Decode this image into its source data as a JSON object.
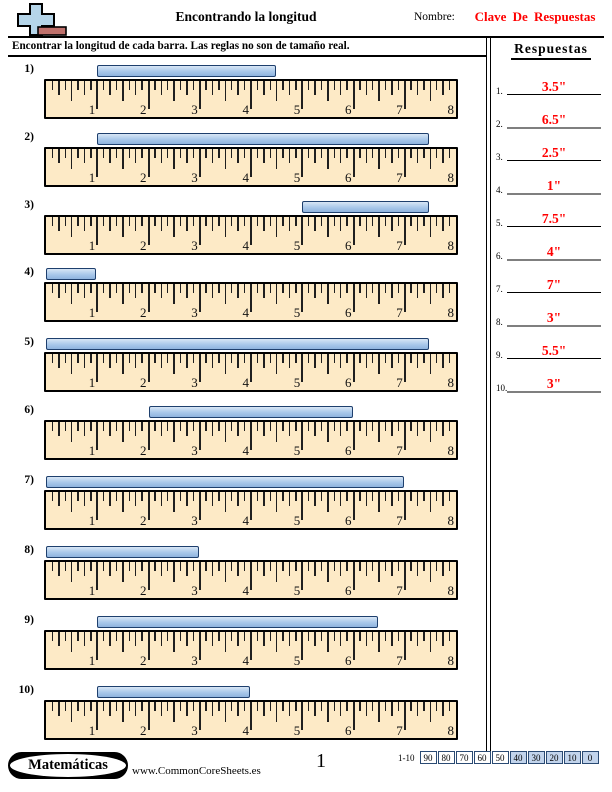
{
  "header": {
    "title": "Encontrando la longitud",
    "name_label": "Nombre:",
    "name_value": "Clave De Respuestas",
    "icon": "plus-ruler-icon"
  },
  "instruction": "Encontrar la longitud de cada barra. Las reglas no son de tamaño real.",
  "answers": {
    "title": "Respuestas",
    "items": [
      {
        "num": "1.",
        "value": "3.5\""
      },
      {
        "num": "2.",
        "value": "6.5\""
      },
      {
        "num": "3.",
        "value": "2.5\""
      },
      {
        "num": "4.",
        "value": "1\""
      },
      {
        "num": "5.",
        "value": "7.5\""
      },
      {
        "num": "6.",
        "value": "4\""
      },
      {
        "num": "7.",
        "value": "7\""
      },
      {
        "num": "8.",
        "value": "3\""
      },
      {
        "num": "9.",
        "value": "5.5\""
      },
      {
        "num": "10.",
        "value": "3\""
      }
    ]
  },
  "ruler": {
    "labels": [
      "1",
      "2",
      "3",
      "4",
      "5",
      "6",
      "7",
      "8"
    ],
    "unit_inches": 8,
    "subdivisions_per_inch": 8
  },
  "problems": [
    {
      "num": "1)",
      "bar_start_in": 1,
      "bar_end_in": 4.5,
      "length": "3.5\""
    },
    {
      "num": "2)",
      "bar_start_in": 1,
      "bar_end_in": 7.5,
      "length": "6.5\""
    },
    {
      "num": "3)",
      "bar_start_in": 5,
      "bar_end_in": 7.5,
      "length": "2.5\""
    },
    {
      "num": "4)",
      "bar_start_in": 0,
      "bar_end_in": 1,
      "length": "1\""
    },
    {
      "num": "5)",
      "bar_start_in": 0,
      "bar_end_in": 7.5,
      "length": "7.5\""
    },
    {
      "num": "6)",
      "bar_start_in": 2,
      "bar_end_in": 6,
      "length": "4\""
    },
    {
      "num": "7)",
      "bar_start_in": 0,
      "bar_end_in": 7,
      "length": "7\""
    },
    {
      "num": "8)",
      "bar_start_in": 0,
      "bar_end_in": 3,
      "length": "3\""
    },
    {
      "num": "9)",
      "bar_start_in": 1,
      "bar_end_in": 6.5,
      "length": "5.5\""
    },
    {
      "num": "10)",
      "bar_start_in": 1,
      "bar_end_in": 4,
      "length": "3\""
    }
  ],
  "footer": {
    "subject_badge": "Matemáticas",
    "website": "www.CommonCoreSheets.es",
    "page_number": "1",
    "score_strip": {
      "label": "1-10",
      "cells": [
        "90",
        "80",
        "70",
        "60",
        "50",
        "40",
        "30",
        "20",
        "10",
        "0"
      ],
      "highlight_start_index": 5
    }
  },
  "colors": {
    "answer_red": "#ff0000",
    "ruler_fill": "#fdeac6",
    "bar_fill": "#a9c8ea",
    "bar_border": "#1e3f6d",
    "score_highlight": "#c2d4ec"
  }
}
